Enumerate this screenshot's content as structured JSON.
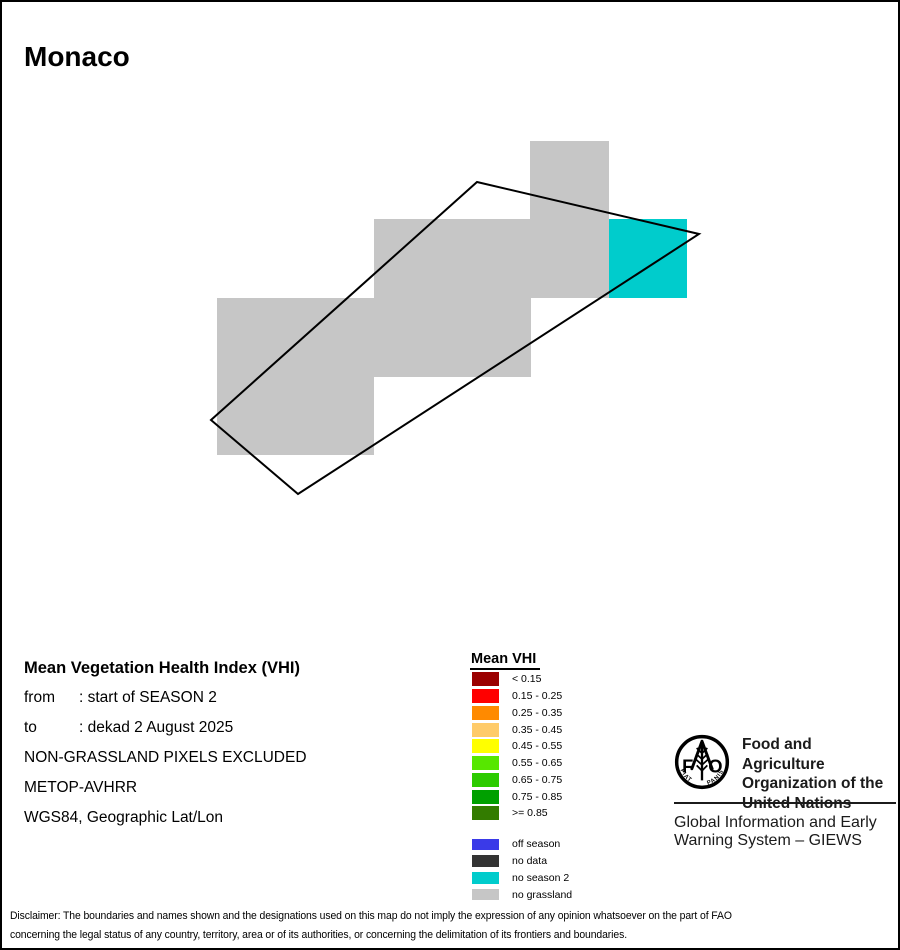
{
  "page": {
    "title": "Monaco",
    "background": "#FFFFFF",
    "border_color": "#000000"
  },
  "map": {
    "grid": {
      "origin_x": 215,
      "origin_y": 139,
      "cell_w": 78.3,
      "cell_h": 78.4
    },
    "colors": {
      "no_grassland": "#C6C6C6",
      "no_season2": "#00CCCC",
      "boundary": "#000000"
    },
    "cells": [
      {
        "row": 0,
        "col": 4,
        "type": "no_grassland"
      },
      {
        "row": 1,
        "col": 2,
        "type": "no_grassland"
      },
      {
        "row": 1,
        "col": 3,
        "type": "no_grassland"
      },
      {
        "row": 1,
        "col": 4,
        "type": "no_grassland"
      },
      {
        "row": 1,
        "col": 5,
        "type": "no_season2"
      },
      {
        "row": 2,
        "col": 0,
        "type": "no_grassland"
      },
      {
        "row": 2,
        "col": 1,
        "type": "no_grassland"
      },
      {
        "row": 2,
        "col": 2,
        "type": "no_grassland"
      },
      {
        "row": 2,
        "col": 3,
        "type": "no_grassland"
      },
      {
        "row": 3,
        "col": 0,
        "type": "no_grassland"
      },
      {
        "row": 3,
        "col": 1,
        "type": "no_grassland"
      }
    ],
    "boundary_points": [
      [
        475,
        180
      ],
      [
        697,
        232
      ],
      [
        296,
        492
      ],
      [
        209,
        418
      ]
    ]
  },
  "info": {
    "title": "Mean Vegetation Health Index (VHI)",
    "rows": [
      {
        "label": "from",
        "value": ": start of SEASON 2"
      },
      {
        "label": "to",
        "value": ": dekad 2 August 2025"
      }
    ],
    "lines": [
      "NON-GRASSLAND PIXELS EXCLUDED",
      "METOP-AVHRR",
      "WGS84, Geographic Lat/Lon"
    ]
  },
  "legend": {
    "title": "Mean VHI",
    "vhi_classes": [
      {
        "label": "< 0.15",
        "color": "#9B0000"
      },
      {
        "label": "0.15 - 0.25",
        "color": "#FF0000"
      },
      {
        "label": "0.25 - 0.35",
        "color": "#FF8A00"
      },
      {
        "label": "0.35 - 0.45",
        "color": "#FFCB69"
      },
      {
        "label": "0.45 - 0.55",
        "color": "#FFFF00"
      },
      {
        "label": "0.55 - 0.65",
        "color": "#57E700"
      },
      {
        "label": "0.65 - 0.75",
        "color": "#2DCB00"
      },
      {
        "label": "0.75 - 0.85",
        "color": "#00A000"
      },
      {
        "label": ">= 0.85",
        "color": "#337C00"
      }
    ],
    "status_classes": [
      {
        "label": "off season",
        "color": "#3A3AE8"
      },
      {
        "label": "no data",
        "color": "#333333"
      },
      {
        "label": "no season 2",
        "color": "#00CCCC"
      },
      {
        "label": "no grassland",
        "color": "#C6C6C6"
      }
    ]
  },
  "branding": {
    "org_lines": [
      "Food and Agriculture",
      "Organization of the",
      "United Nations"
    ],
    "giews_lines": [
      "Global Information and Early",
      "Warning System – GIEWS"
    ],
    "logo": {
      "letter_f": "F",
      "letter_o": "O",
      "motto_left": "FIAT",
      "motto_right": "PANIS"
    }
  },
  "disclaimer": {
    "lines": [
      "Disclaimer: The boundaries and names shown and the designations used on this map do not imply the expression of any opinion whatsoever on the part of FAO",
      "concerning the legal status of any country, territory, area or of its authorities, or concerning the delimitation of its frontiers and boundaries."
    ]
  }
}
